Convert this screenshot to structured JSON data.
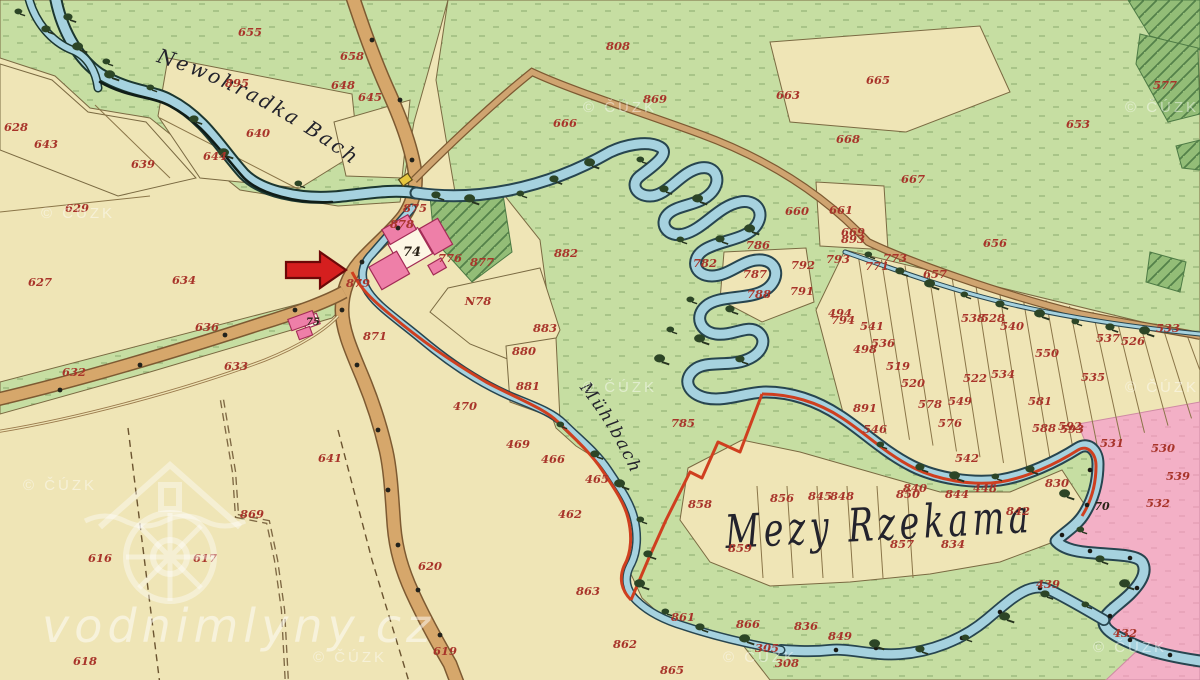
{
  "map": {
    "labels": {
      "stream_name": "Newohradka Bach",
      "millrace_name": "Mühlbach",
      "area_name": "Mezy Rzekama"
    },
    "watermarks": {
      "site": "vodnimlyny.cz",
      "copyright": "© ČÚZK",
      "copyright_positions": [
        [
          78,
          218
        ],
        [
          620,
          112
        ],
        [
          1162,
          112
        ],
        [
          60,
          490
        ],
        [
          620,
          392
        ],
        [
          1162,
          392
        ],
        [
          350,
          662
        ],
        [
          760,
          662
        ],
        [
          1130,
          652
        ]
      ]
    },
    "marker": {
      "arrow": "points-to-mill"
    },
    "colors": {
      "field_cream": "#efe5b6",
      "meadow_green": "#c6dea2",
      "orchard_green": "#93bd77",
      "water_blue": "#a6d2df",
      "road_tan": "#d6a76b",
      "boundary_red": "#cf3f1f",
      "neighbor_pink": "#f3b0c6",
      "building_pink": "#ee7fa8",
      "parcel_red": "#a8342a"
    },
    "parcel_labels": [
      {
        "n": "655",
        "x": 250,
        "y": 36
      },
      {
        "n": "658",
        "x": 352,
        "y": 60
      },
      {
        "n": "648",
        "x": 343,
        "y": 89
      },
      {
        "n": "645",
        "x": 370,
        "y": 101
      },
      {
        "n": "895",
        "x": 237,
        "y": 87
      },
      {
        "n": "640",
        "x": 258,
        "y": 137
      },
      {
        "n": "644",
        "x": 215,
        "y": 160
      },
      {
        "n": "639",
        "x": 143,
        "y": 168
      },
      {
        "n": "643",
        "x": 46,
        "y": 148
      },
      {
        "n": "628",
        "x": 16,
        "y": 131
      },
      {
        "n": "629",
        "x": 77,
        "y": 212
      },
      {
        "n": "627",
        "x": 40,
        "y": 286
      },
      {
        "n": "634",
        "x": 184,
        "y": 284
      },
      {
        "n": "636",
        "x": 207,
        "y": 331
      },
      {
        "n": "632",
        "x": 74,
        "y": 376
      },
      {
        "n": "633",
        "x": 236,
        "y": 370
      },
      {
        "n": "808",
        "x": 618,
        "y": 50
      },
      {
        "n": "869",
        "x": 655,
        "y": 103
      },
      {
        "n": "666",
        "x": 565,
        "y": 127
      },
      {
        "n": "663",
        "x": 788,
        "y": 99
      },
      {
        "n": "665",
        "x": 878,
        "y": 84
      },
      {
        "n": "653",
        "x": 1078,
        "y": 128
      },
      {
        "n": "577",
        "x": 1165,
        "y": 89
      },
      {
        "n": "667",
        "x": 913,
        "y": 183
      },
      {
        "n": "656",
        "x": 995,
        "y": 247
      },
      {
        "n": "660",
        "x": 797,
        "y": 215
      },
      {
        "n": "661",
        "x": 841,
        "y": 214
      },
      {
        "n": "669",
        "x": 853,
        "y": 236
      },
      {
        "n": "668",
        "x": 848,
        "y": 143
      },
      {
        "n": "875",
        "x": 415,
        "y": 212
      },
      {
        "n": "878",
        "x": 402,
        "y": 228
      },
      {
        "n": "776",
        "x": 450,
        "y": 262
      },
      {
        "n": "877",
        "x": 482,
        "y": 266
      },
      {
        "n": "879",
        "x": 358,
        "y": 287
      },
      {
        "n": "N78",
        "x": 478,
        "y": 305
      },
      {
        "n": "871",
        "x": 375,
        "y": 340
      },
      {
        "n": "880",
        "x": 524,
        "y": 355
      },
      {
        "n": "882",
        "x": 566,
        "y": 257
      },
      {
        "n": "883",
        "x": 545,
        "y": 332
      },
      {
        "n": "881",
        "x": 528,
        "y": 390
      },
      {
        "n": "470",
        "x": 465,
        "y": 410
      },
      {
        "n": "469",
        "x": 518,
        "y": 448
      },
      {
        "n": "466",
        "x": 553,
        "y": 463
      },
      {
        "n": "462",
        "x": 570,
        "y": 518
      },
      {
        "n": "465",
        "x": 597,
        "y": 483
      },
      {
        "n": "641",
        "x": 330,
        "y": 462
      },
      {
        "n": "616",
        "x": 100,
        "y": 562
      },
      {
        "n": "617",
        "x": 205,
        "y": 562
      },
      {
        "n": "618",
        "x": 85,
        "y": 665
      },
      {
        "n": "620",
        "x": 430,
        "y": 570
      },
      {
        "n": "619",
        "x": 445,
        "y": 655
      },
      {
        "n": "869",
        "x": 252,
        "y": 518
      },
      {
        "n": "785",
        "x": 683,
        "y": 427
      },
      {
        "n": "858",
        "x": 700,
        "y": 508
      },
      {
        "n": "786",
        "x": 758,
        "y": 249
      },
      {
        "n": "787",
        "x": 755,
        "y": 278
      },
      {
        "n": "782",
        "x": 705,
        "y": 267
      },
      {
        "n": "788",
        "x": 759,
        "y": 298
      },
      {
        "n": "792",
        "x": 803,
        "y": 269
      },
      {
        "n": "793",
        "x": 838,
        "y": 263
      },
      {
        "n": "791",
        "x": 802,
        "y": 295
      },
      {
        "n": "794",
        "x": 843,
        "y": 324
      },
      {
        "n": "893",
        "x": 853,
        "y": 243
      },
      {
        "n": "773",
        "x": 895,
        "y": 262
      },
      {
        "n": "771",
        "x": 877,
        "y": 270
      },
      {
        "n": "657",
        "x": 935,
        "y": 278
      },
      {
        "n": "494",
        "x": 840,
        "y": 317
      },
      {
        "n": "541",
        "x": 872,
        "y": 330
      },
      {
        "n": "536",
        "x": 883,
        "y": 347
      },
      {
        "n": "498",
        "x": 865,
        "y": 353
      },
      {
        "n": "519",
        "x": 898,
        "y": 370
      },
      {
        "n": "538",
        "x": 973,
        "y": 322
      },
      {
        "n": "528",
        "x": 993,
        "y": 322
      },
      {
        "n": "540",
        "x": 1012,
        "y": 330
      },
      {
        "n": "550",
        "x": 1047,
        "y": 357
      },
      {
        "n": "522",
        "x": 975,
        "y": 382
      },
      {
        "n": "534",
        "x": 1003,
        "y": 378
      },
      {
        "n": "520",
        "x": 913,
        "y": 387
      },
      {
        "n": "891",
        "x": 865,
        "y": 412
      },
      {
        "n": "546",
        "x": 875,
        "y": 433
      },
      {
        "n": "578",
        "x": 930,
        "y": 408
      },
      {
        "n": "549",
        "x": 960,
        "y": 405
      },
      {
        "n": "576",
        "x": 950,
        "y": 427
      },
      {
        "n": "581",
        "x": 1040,
        "y": 405
      },
      {
        "n": "592",
        "x": 1070,
        "y": 430
      },
      {
        "n": "542",
        "x": 967,
        "y": 462
      },
      {
        "n": "840",
        "x": 915,
        "y": 492
      },
      {
        "n": "448",
        "x": 985,
        "y": 492
      },
      {
        "n": "535",
        "x": 1093,
        "y": 381
      },
      {
        "n": "537",
        "x": 1108,
        "y": 342
      },
      {
        "n": "526",
        "x": 1133,
        "y": 345
      },
      {
        "n": "533",
        "x": 1168,
        "y": 332
      },
      {
        "n": "588",
        "x": 1044,
        "y": 432
      },
      {
        "n": "593",
        "x": 1072,
        "y": 433
      },
      {
        "n": "531",
        "x": 1112,
        "y": 447
      },
      {
        "n": "530",
        "x": 1163,
        "y": 452
      },
      {
        "n": "539",
        "x": 1178,
        "y": 480
      },
      {
        "n": "830",
        "x": 1057,
        "y": 487
      },
      {
        "n": "532",
        "x": 1158,
        "y": 507
      },
      {
        "n": "439",
        "x": 1048,
        "y": 588
      },
      {
        "n": "432",
        "x": 1125,
        "y": 637
      },
      {
        "n": "856",
        "x": 782,
        "y": 502
      },
      {
        "n": "845",
        "x": 820,
        "y": 500
      },
      {
        "n": "848",
        "x": 842,
        "y": 500
      },
      {
        "n": "850",
        "x": 908,
        "y": 498
      },
      {
        "n": "844",
        "x": 957,
        "y": 498
      },
      {
        "n": "842",
        "x": 1018,
        "y": 515
      },
      {
        "n": "859",
        "x": 740,
        "y": 552
      },
      {
        "n": "857",
        "x": 902,
        "y": 548
      },
      {
        "n": "834",
        "x": 953,
        "y": 548
      },
      {
        "n": "861",
        "x": 683,
        "y": 621
      },
      {
        "n": "862",
        "x": 625,
        "y": 648
      },
      {
        "n": "865",
        "x": 672,
        "y": 674
      },
      {
        "n": "305",
        "x": 767,
        "y": 652
      },
      {
        "n": "308",
        "x": 787,
        "y": 667
      },
      {
        "n": "866",
        "x": 748,
        "y": 628
      },
      {
        "n": "836",
        "x": 806,
        "y": 630
      },
      {
        "n": "849",
        "x": 840,
        "y": 640
      },
      {
        "n": "863",
        "x": 588,
        "y": 595
      },
      {
        "n": "74",
        "x": 412,
        "y": 256,
        "c": "#2b2317",
        "s": 13
      },
      {
        "n": "75",
        "x": 313,
        "y": 325,
        "c": "#2b2317",
        "s": 10
      },
      {
        "n": "70",
        "x": 1102,
        "y": 510,
        "c": "#2b2317",
        "s": 11
      }
    ]
  }
}
